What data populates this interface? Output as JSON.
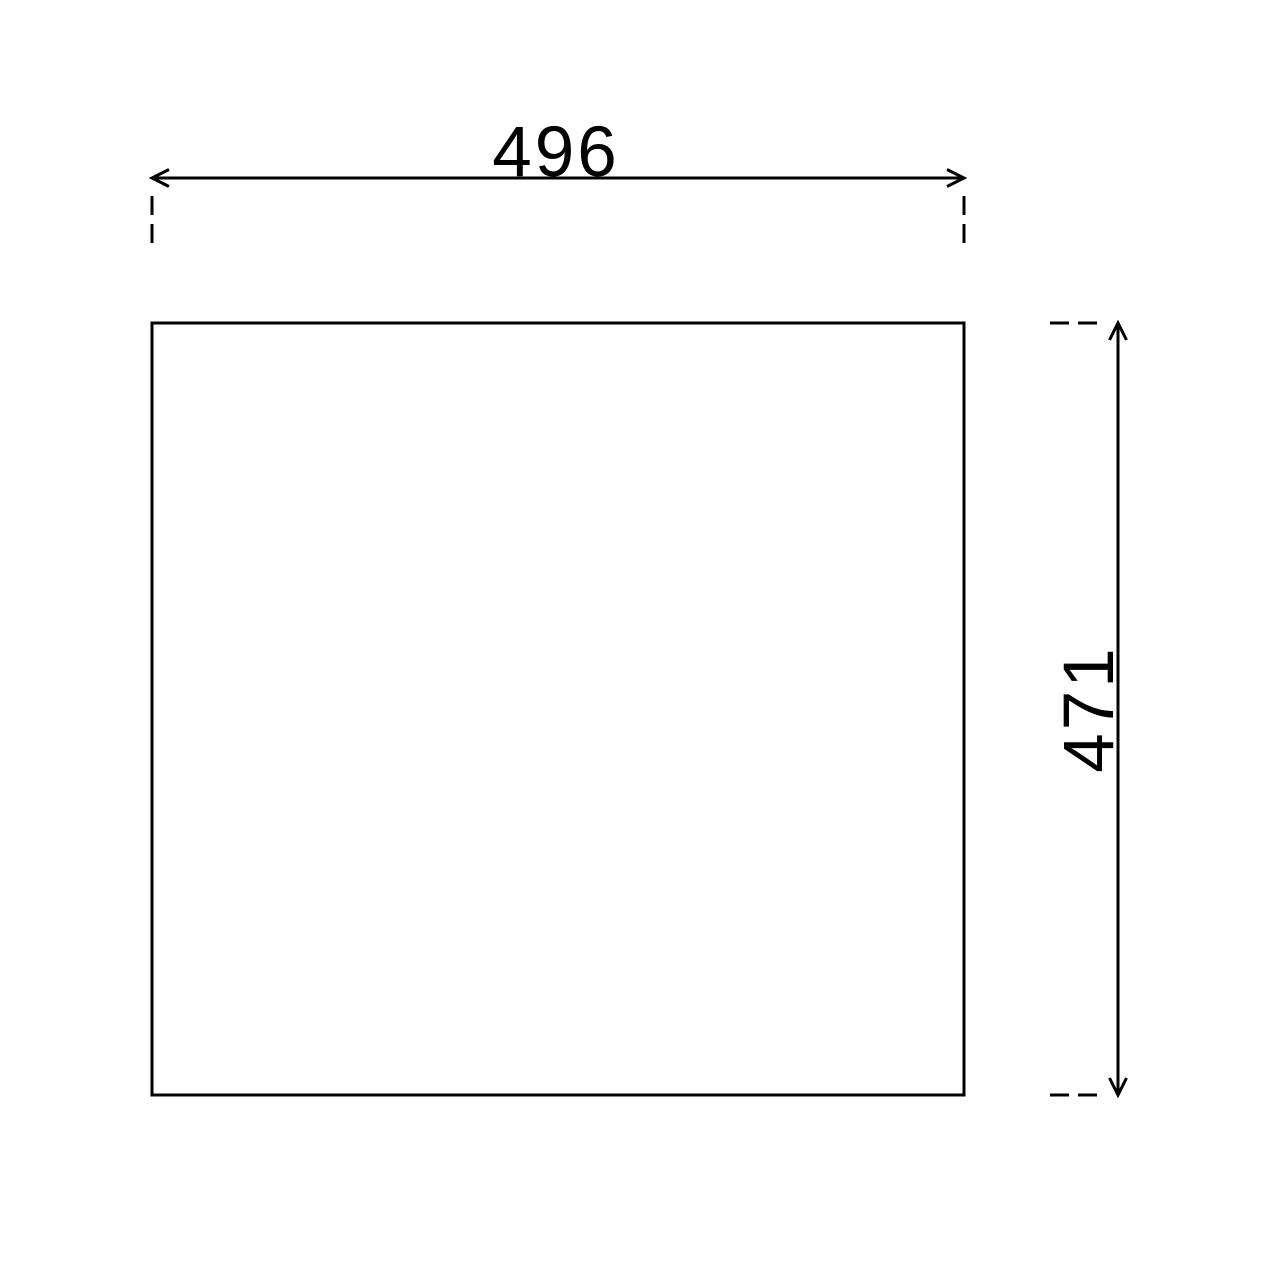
{
  "canvas": {
    "background": "#ffffff",
    "line_color": "#000000"
  },
  "drawing": {
    "shape": "rectangle-outline",
    "dimensions": {
      "width": {
        "value": "496",
        "orientation": "horizontal",
        "position": "top"
      },
      "height": {
        "value": "471",
        "orientation": "vertical",
        "position": "right"
      }
    }
  }
}
